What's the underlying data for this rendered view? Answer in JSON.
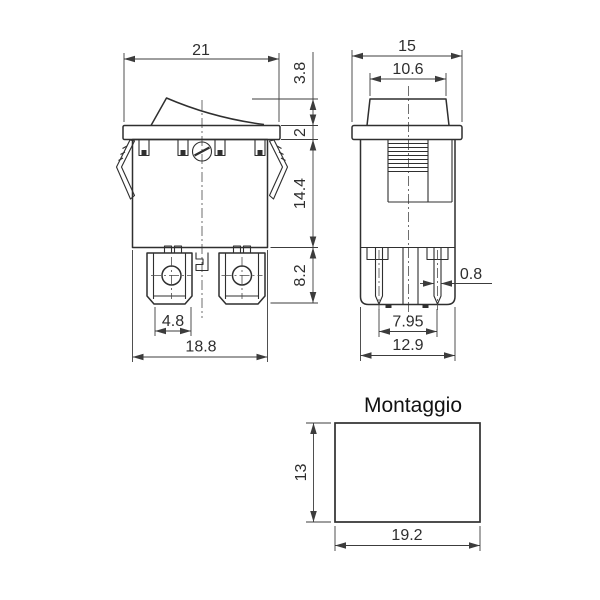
{
  "drawing": {
    "type": "technical-drawing-rocker-switch",
    "front_view": {
      "dims": {
        "top_width": "21",
        "rocker_height": "3.8",
        "bezel_thickness": "2",
        "body_height": "14.4",
        "terminal_height": "8.2",
        "terminal_width": "4.8",
        "body_width": "18.8"
      }
    },
    "side_view": {
      "dims": {
        "top_width": "15",
        "rocker_width": "10.6",
        "pin_thickness": "0.8",
        "pin_spacing": "7.95",
        "body_width": "12.9"
      }
    },
    "mounting_view": {
      "title": "Montaggio",
      "dims": {
        "cutout_height": "13",
        "cutout_width": "19.2"
      }
    },
    "colors": {
      "line": "#2f2f2f",
      "dimension": "#3c3c3c",
      "background": "#ffffff"
    }
  }
}
